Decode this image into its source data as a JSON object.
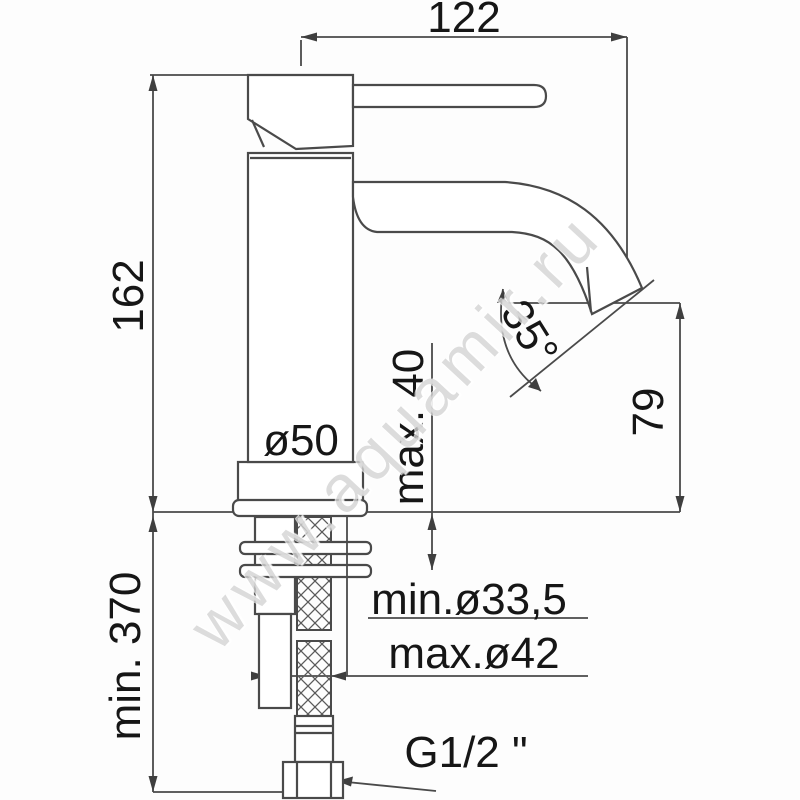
{
  "watermark": "www.aquamir.ru",
  "dims": {
    "spout_reach": "122",
    "total_height": "162",
    "hose_min_length": "min. 370",
    "base_diameter": "ø50",
    "max_deck_thickness": "max. 40",
    "spout_angle": "35°",
    "outlet_height": "79",
    "hole_diameter_min": "min.ø33,5",
    "hole_diameter_max": "max.ø42",
    "connection_thread": "G1/2 \""
  },
  "colors": {
    "line": "#4a4a4a",
    "text": "#161616",
    "watermark": "#8c8c8c",
    "background": "#fdfdfd"
  }
}
